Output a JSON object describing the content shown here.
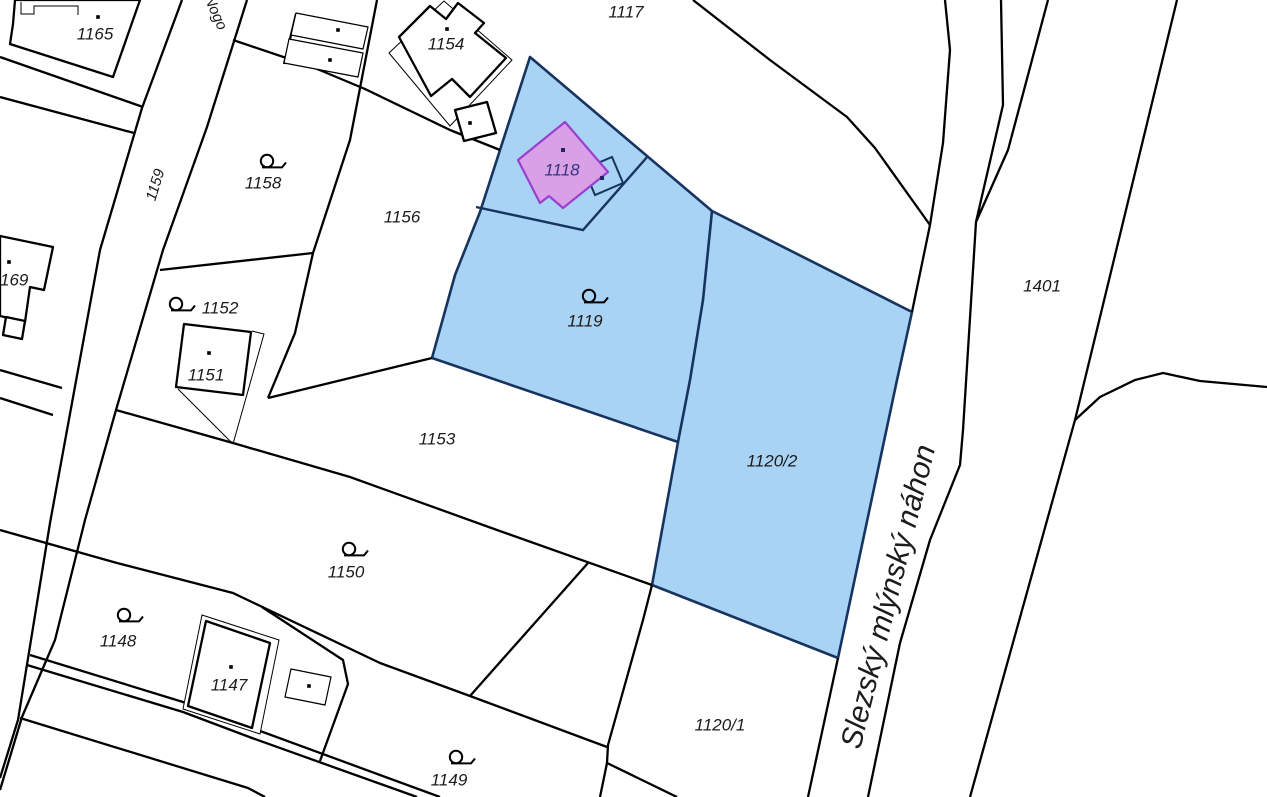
{
  "map": {
    "title": "cadastral-parcel-map",
    "colors": {
      "background": "#ffffff",
      "parcel_line": "#000000",
      "highlight_fill": "#a9d3f4",
      "highlight_stroke": "#17335f",
      "building_fill": "#d9a0e8",
      "building_stroke": "#9a3fd0",
      "label_color": "#1c1c1c",
      "selected_label_color": "#35357d"
    },
    "watercourse_label": "Slezský mlýnský náhon",
    "street_label": "Nogo",
    "highlighted_parcels": [
      "1119",
      "1120/2"
    ],
    "selected_building": "1118",
    "labels": [
      {
        "text": "1165",
        "x": 95,
        "y": 35,
        "rot": 0,
        "size": 17
      },
      {
        "text": "1159",
        "x": 156,
        "y": 185,
        "rot": -73,
        "size": 15
      },
      {
        "text": "Nogo",
        "x": 215,
        "y": 13,
        "rot": 66,
        "size": 15
      },
      {
        "text": "1158",
        "x": 263,
        "y": 184,
        "rot": 0,
        "size": 17
      },
      {
        "text": "169",
        "x": 0,
        "y": 281,
        "rot": 0,
        "size": 17,
        "anchor": "start"
      },
      {
        "text": "1152",
        "x": 220,
        "y": 309,
        "rot": 0,
        "size": 17
      },
      {
        "text": "1151",
        "x": 206,
        "y": 376,
        "rot": 0,
        "size": 17
      },
      {
        "text": "1156",
        "x": 402,
        "y": 218,
        "rot": 0,
        "size": 17
      },
      {
        "text": "1154",
        "x": 446,
        "y": 45,
        "rot": 0,
        "size": 17
      },
      {
        "text": "1117",
        "x": 626,
        "y": 13,
        "rot": 0,
        "size": 17
      },
      {
        "text": "1118",
        "x": 562,
        "y": 171,
        "rot": 0,
        "size": 17,
        "selected": true
      },
      {
        "text": "1119",
        "x": 585,
        "y": 322,
        "rot": 0,
        "size": 17
      },
      {
        "text": "1153",
        "x": 437,
        "y": 440,
        "rot": 0,
        "size": 17
      },
      {
        "text": "1150",
        "x": 346,
        "y": 573,
        "rot": 0,
        "size": 17
      },
      {
        "text": "1148",
        "x": 118,
        "y": 642,
        "rot": 0,
        "size": 17
      },
      {
        "text": "1147",
        "x": 229,
        "y": 686,
        "rot": 0,
        "size": 17
      },
      {
        "text": "1149",
        "x": 449,
        "y": 781,
        "rot": 0,
        "size": 17
      },
      {
        "text": "1120/2",
        "x": 772,
        "y": 462,
        "rot": 0,
        "size": 17
      },
      {
        "text": "1120/1",
        "x": 720,
        "y": 726,
        "rot": 0,
        "size": 17
      },
      {
        "text": "1401",
        "x": 1042,
        "y": 287,
        "rot": 0,
        "size": 17
      },
      {
        "text": "Slezský mlýnský náhon",
        "x": 890,
        "y": 597,
        "rot": -76,
        "size": 30
      }
    ]
  }
}
